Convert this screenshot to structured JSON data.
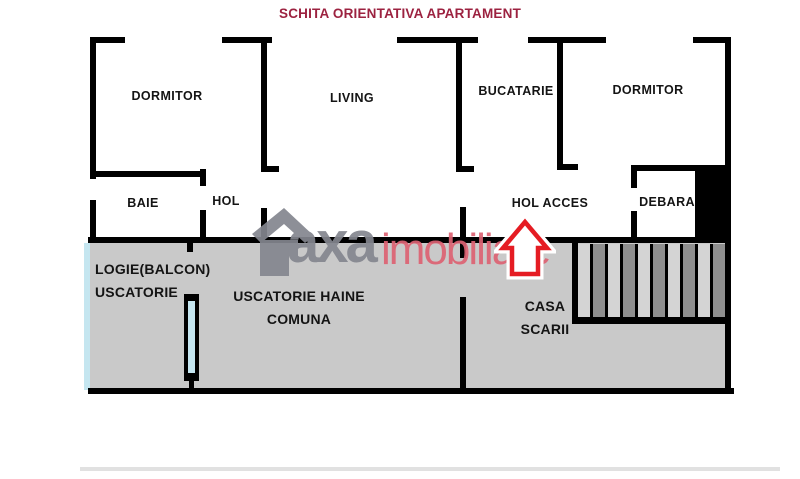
{
  "title": "SCHITA ORIENTATIVA APARTAMENT",
  "rooms": {
    "dormitor_left": "DORMITOR",
    "living": "LIVING",
    "bucatarie": "BUCATARIE",
    "dormitor_right": "DORMITOR",
    "baie": "BAIE",
    "hol": "HOL",
    "hol_acces": "HOL ACCES",
    "debara": "DEBARA",
    "logie_line1": "LOGIE(BALCON)",
    "logie_line2": "USCATORIE",
    "uscatorie_line1": "USCATORIE HAINE",
    "uscatorie_line2": "COMUNA",
    "casa_line1": "CASA",
    "casa_line2": "SCARII"
  },
  "watermark": {
    "brand_gray": "axa",
    "brand_red": "imobiliare"
  },
  "stairs": {
    "step_count": 10
  },
  "colors": {
    "title": "#9c2240",
    "wall": "#000000",
    "floor_gray": "#c9c9c9",
    "stair_light": "#d4d4d4",
    "stair_dark": "#8f8f8f",
    "window_blue": "#c5e6f0",
    "arrow_red": "#e51c23",
    "wm_gray": "#84868f",
    "wm_pink": "#dd6273"
  }
}
